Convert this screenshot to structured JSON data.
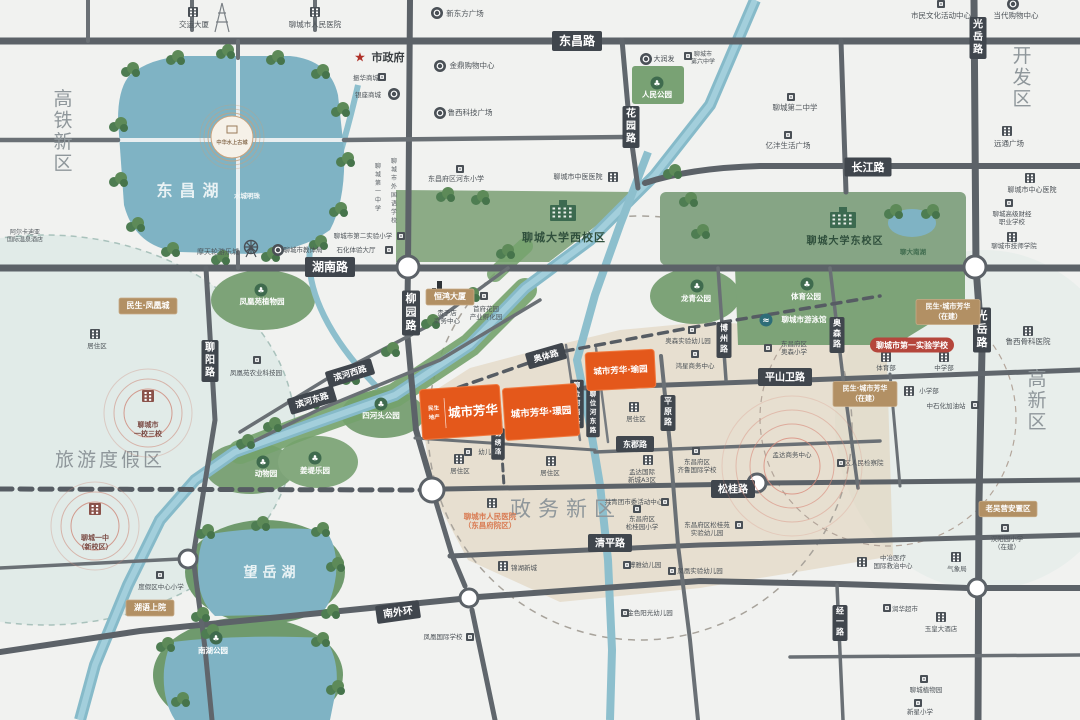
{
  "colors": {
    "project_orange": "#e4581b",
    "badge_gold": "#b29064",
    "road_badge": "#40464d",
    "badge_red": "#b5463c",
    "water": "#7fb3c4",
    "park_green": "#7da378",
    "region_gray": "#8f979b"
  },
  "map": {
    "regions": [
      {
        "text": "高铁新区",
        "x": 63,
        "y": 105,
        "v": 1,
        "fs": 19
      },
      {
        "text": "开发区",
        "x": 1022,
        "y": 62,
        "v": 1,
        "fs": 19
      },
      {
        "text": "高新区",
        "x": 1037,
        "y": 385,
        "v": 1,
        "fs": 19
      },
      {
        "text": "旅游度假区",
        "x": 110,
        "y": 466,
        "fs": 19,
        "ls": 3
      },
      {
        "text": "政务新区",
        "x": 566,
        "y": 516,
        "fs": 21,
        "ls": 7
      }
    ],
    "water_labels": [
      {
        "text": "东昌湖",
        "x": 191,
        "y": 196,
        "fs": 16,
        "ls": 7,
        "color": "#e9f2f4"
      },
      {
        "text": "望岳湖",
        "x": 272,
        "y": 577,
        "fs": 14,
        "ls": 5,
        "color": "#eaf3f5"
      },
      {
        "text": "水城明珠",
        "x": 247,
        "y": 198,
        "fs": 6.5,
        "color": "#f2f7f8"
      },
      {
        "text": "聊大南湖",
        "x": 913,
        "y": 254,
        "fs": 6.5,
        "color": "#3f6b4e"
      }
    ],
    "road_labels": [
      {
        "text": "东昌路",
        "x": 577,
        "y": 41,
        "fs": 12
      },
      {
        "text": "长江路",
        "x": 868,
        "y": 167,
        "fs": 11
      },
      {
        "text": "湖南路",
        "x": 330,
        "y": 267,
        "fs": 12
      },
      {
        "text": "柳园路",
        "x": 411,
        "y": 313,
        "v": 1,
        "fs": 11
      },
      {
        "text": "花园路",
        "x": 631,
        "y": 127,
        "v": 1,
        "fs": 10
      },
      {
        "text": "聊阳路",
        "x": 210,
        "y": 361,
        "v": 1,
        "fs": 10
      },
      {
        "text": "光岳路",
        "x": 978,
        "y": 38,
        "v": 1,
        "fs": 10
      },
      {
        "text": "光岳路",
        "x": 982,
        "y": 330,
        "v": 1,
        "fs": 11
      },
      {
        "text": "平原路",
        "x": 668,
        "y": 413,
        "v": 1,
        "fs": 8
      },
      {
        "text": "博州路",
        "x": 724,
        "y": 340,
        "v": 1,
        "fs": 8
      },
      {
        "text": "奥森路",
        "x": 837,
        "y": 335,
        "v": 1,
        "fs": 8
      },
      {
        "text": "经一路",
        "x": 840,
        "y": 623,
        "v": 1,
        "fs": 8
      },
      {
        "text": "平山卫路",
        "x": 785,
        "y": 377,
        "fs": 10
      },
      {
        "text": "东郡路",
        "x": 635,
        "y": 444,
        "fs": 8
      },
      {
        "text": "松桂路",
        "x": 733,
        "y": 489,
        "fs": 10
      },
      {
        "text": "清平路",
        "x": 610,
        "y": 543,
        "fs": 10
      },
      {
        "text": "南外环",
        "x": 398,
        "y": 612,
        "rot": -8,
        "fs": 10
      },
      {
        "text": "滨河西路",
        "x": 350,
        "y": 373,
        "rot": -17,
        "fs": 8.5
      },
      {
        "text": "滨河东路",
        "x": 312,
        "y": 400,
        "rot": -17,
        "fs": 8.5
      },
      {
        "text": "奥体路",
        "x": 546,
        "y": 356,
        "rot": -16,
        "fs": 8.5
      },
      {
        "text": "聊位河西路",
        "x": 577,
        "y": 404,
        "v": 1,
        "fs": 6.5
      },
      {
        "text": "聊位河东路",
        "x": 593,
        "y": 413,
        "v": 1,
        "fs": 6.5
      },
      {
        "text": "锦绣路",
        "x": 498,
        "y": 444,
        "v": 1,
        "fs": 6.5
      }
    ],
    "campuses": [
      {
        "lines": [
          "聊城大学西校区"
        ],
        "x": 564,
        "y": 241,
        "ix": 563,
        "iy": 213,
        "fs": 11
      },
      {
        "lines": [
          "聊城大学东校区"
        ],
        "x": 845,
        "y": 244,
        "ix": 843,
        "iy": 220,
        "fs": 10
      }
    ],
    "parks": [
      {
        "text": "人民公园",
        "x": 657,
        "y": 97,
        "ix": 657,
        "iy": 83
      },
      {
        "text": "凤凰苑植物园",
        "x": 262,
        "y": 304,
        "ix": 261,
        "iy": 290
      },
      {
        "text": "龙青公园",
        "x": 696,
        "y": 301,
        "ix": 697,
        "iy": 286
      },
      {
        "text": "体育公园",
        "x": 806,
        "y": 299,
        "ix": 807,
        "iy": 284
      },
      {
        "text": "聊城市游泳馆",
        "x": 804,
        "y": 322,
        "ix": 766,
        "iy": 320,
        "swim": 1
      },
      {
        "text": "四河头公园",
        "x": 381,
        "y": 418,
        "ix": 381,
        "iy": 404
      },
      {
        "text": "动物园",
        "x": 266,
        "y": 476,
        "ix": 263,
        "iy": 462
      },
      {
        "text": "姜堤乐园",
        "x": 315,
        "y": 473,
        "ix": 315,
        "iy": 458
      },
      {
        "text": "南湖公园",
        "x": 213,
        "y": 653,
        "ix": 216,
        "iy": 638
      }
    ],
    "pois": [
      {
        "lines": [
          "交运大厦"
        ],
        "x": 194,
        "y": 27,
        "ix": 193,
        "iy": 12,
        "icon": "b"
      },
      {
        "lines": [
          "聊城市人民医院"
        ],
        "x": 315,
        "y": 27,
        "ix": 315,
        "iy": 12,
        "icon": "b"
      },
      {
        "lines": [
          "新东方广场"
        ],
        "x": 465,
        "y": 16,
        "ix": 437,
        "iy": 13,
        "icon": "c"
      },
      {
        "lines": [
          "市民文化活动中心"
        ],
        "x": 941,
        "y": 18,
        "ix": 941,
        "iy": 4,
        "icon": "s"
      },
      {
        "lines": [
          "当代购物中心"
        ],
        "x": 1016,
        "y": 18,
        "ix": 1013,
        "iy": 4,
        "icon": "c"
      },
      {
        "lines": [
          "市政府"
        ],
        "x": 388,
        "y": 61,
        "ix": 360,
        "iy": 57,
        "icon": "star",
        "fs": 11,
        "color": "#3a3f42",
        "bold": 1
      },
      {
        "lines": [
          "金鼎购物中心"
        ],
        "x": 472,
        "y": 68,
        "ix": 440,
        "iy": 66,
        "icon": "c"
      },
      {
        "lines": [
          "振华商城"
        ],
        "x": 366,
        "y": 80,
        "ix": 382,
        "iy": 77,
        "icon": "s",
        "fs": 6.5
      },
      {
        "lines": [
          "银座商城"
        ],
        "x": 368,
        "y": 97,
        "ix": 394,
        "iy": 94,
        "icon": "c",
        "fs": 6.5
      },
      {
        "lines": [
          "鲁西科技广场"
        ],
        "x": 470,
        "y": 115,
        "ix": 440,
        "iy": 113,
        "icon": "c"
      },
      {
        "lines": [
          "大润发"
        ],
        "x": 664,
        "y": 61,
        "ix": 646,
        "iy": 59,
        "icon": "c",
        "fs": 7
      },
      {
        "lines": [
          "聊城市",
          "第六中学"
        ],
        "x": 703,
        "y": 56,
        "ix": 688,
        "iy": 56,
        "icon": "s",
        "fs": 6
      },
      {
        "lines": [
          "聊城第二中学"
        ],
        "x": 795,
        "y": 110,
        "ix": 791,
        "iy": 97,
        "icon": "s"
      },
      {
        "lines": [
          "亿沣生活广场"
        ],
        "x": 788,
        "y": 148,
        "ix": 788,
        "iy": 135,
        "icon": "s"
      },
      {
        "lines": [
          "远通广场"
        ],
        "x": 1009,
        "y": 146,
        "ix": 1007,
        "iy": 131,
        "icon": "b"
      },
      {
        "lines": [
          "聊城市中心医院"
        ],
        "x": 1032,
        "y": 192,
        "ix": 1030,
        "iy": 178,
        "icon": "b",
        "fs": 7
      },
      {
        "lines": [
          "聊城高级财经",
          "职业学校"
        ],
        "x": 1012,
        "y": 216,
        "ix": 1009,
        "iy": 203,
        "icon": "s",
        "fs": 6.5
      },
      {
        "lines": [
          "聊城市技师学院"
        ],
        "x": 1014,
        "y": 248,
        "ix": 1012,
        "iy": 237,
        "icon": "b",
        "fs": 6.5
      },
      {
        "lines": [
          "鲁西骨科医院"
        ],
        "x": 1028,
        "y": 344,
        "ix": 1028,
        "iy": 331,
        "icon": "b"
      },
      {
        "lines": [
          "东昌府区河东小学"
        ],
        "x": 456,
        "y": 181,
        "ix": 460,
        "iy": 169,
        "icon": "s",
        "fs": 7
      },
      {
        "lines": [
          "聊城市中医医院"
        ],
        "x": 578,
        "y": 179,
        "ix": 613,
        "iy": 177,
        "icon": "b",
        "fs": 7
      },
      {
        "text": "聊城市外国语学校",
        "x": 394,
        "y": 163,
        "v": 1,
        "fs": 6
      },
      {
        "text": "聊城第一中学",
        "x": 378,
        "y": 168,
        "v": 1,
        "fs": 6
      },
      {
        "lines": [
          "聊城市第二实验小学"
        ],
        "x": 363,
        "y": 238,
        "ix": 401,
        "iy": 236,
        "icon": "s",
        "fs": 6.5
      },
      {
        "lines": [
          "石化体验大厅"
        ],
        "x": 356,
        "y": 252,
        "ix": 389,
        "iy": 250,
        "icon": "s",
        "fs": 6.5
      },
      {
        "lines": [
          "聊城市教体局"
        ],
        "x": 303,
        "y": 252,
        "ix": 278,
        "iy": 250,
        "icon": "c",
        "fs": 6.5
      },
      {
        "lines": [
          "摩天轮游乐城"
        ],
        "x": 218,
        "y": 254,
        "ix": 251,
        "iy": 247,
        "icon": "f",
        "fs": 7
      },
      {
        "lines": [
          "阿尔卡迪亚",
          "国际温泉酒店"
        ],
        "x": 25,
        "y": 234,
        "fs": 6
      },
      {
        "lines": [
          "贵子店",
          "商务中心"
        ],
        "x": 447,
        "y": 315,
        "ix": 440,
        "iy": 292,
        "icon": "t",
        "fs": 6.5
      },
      {
        "lines": [
          "首府花园",
          "产业孵化园"
        ],
        "x": 486,
        "y": 311,
        "ix": 484,
        "iy": 296,
        "icon": "s",
        "fs": 6.5
      },
      {
        "lines": [
          "凤凰苑农业科技园"
        ],
        "x": 256,
        "y": 375,
        "ix": 257,
        "iy": 360,
        "icon": "s",
        "fs": 6.5
      },
      {
        "lines": [
          "居住区"
        ],
        "x": 97,
        "y": 348,
        "ix": 95,
        "iy": 334,
        "icon": "b",
        "fs": 6.5
      },
      {
        "lines": [
          "居住区"
        ],
        "x": 460,
        "y": 473,
        "ix": 459,
        "iy": 459,
        "icon": "b",
        "fs": 6.5
      },
      {
        "lines": [
          "居住区"
        ],
        "x": 550,
        "y": 475,
        "ix": 551,
        "iy": 461,
        "icon": "b",
        "fs": 6.5
      },
      {
        "lines": [
          "居住区"
        ],
        "x": 636,
        "y": 421,
        "ix": 634,
        "iy": 407,
        "icon": "b",
        "fs": 6.5
      },
      {
        "lines": [
          "幼儿园"
        ],
        "x": 488,
        "y": 454,
        "ix": 468,
        "iy": 452,
        "icon": "s",
        "fs": 6.5
      },
      {
        "lines": [
          "孟达国际",
          "新城A3区"
        ],
        "x": 642,
        "y": 474,
        "ix": 648,
        "iy": 460,
        "icon": "b",
        "fs": 6.5
      },
      {
        "lines": [
          "共青团市委活动中心"
        ],
        "x": 634,
        "y": 504,
        "ix": 665,
        "iy": 502,
        "icon": "s",
        "fs": 6.5
      },
      {
        "lines": [
          "东昌府区",
          "松桂园小学"
        ],
        "x": 642,
        "y": 521,
        "ix": 637,
        "iy": 509,
        "icon": "s",
        "fs": 6.5
      },
      {
        "lines": [
          "东昌府区",
          "齐鲁国际学校"
        ],
        "x": 697,
        "y": 464,
        "ix": 696,
        "iy": 451,
        "icon": "s",
        "fs": 6.5
      },
      {
        "lines": [
          "东昌府区松桂苑",
          "实验幼儿园"
        ],
        "x": 707,
        "y": 527,
        "ix": 739,
        "iy": 525,
        "icon": "s",
        "fs": 6.5
      },
      {
        "lines": [
          "聊城市人民医院",
          "（东昌府院区）"
        ],
        "x": 490,
        "y": 519,
        "ix": 492,
        "iy": 503,
        "icon": "b",
        "fs": 7.5,
        "color": "#d97b52",
        "bold": 1
      },
      {
        "lines": [
          "锦湖新城"
        ],
        "x": 524,
        "y": 570,
        "ix": 503,
        "iy": 566,
        "icon": "b",
        "fs": 6.5
      },
      {
        "lines": [
          "凤凰国际学校"
        ],
        "x": 443,
        "y": 639,
        "ix": 470,
        "iy": 637,
        "icon": "s",
        "fs": 6.5
      },
      {
        "lines": [
          "博雅幼儿园"
        ],
        "x": 645,
        "y": 567,
        "ix": 627,
        "iy": 565,
        "icon": "s",
        "fs": 6.5
      },
      {
        "lines": [
          "凤凰实验幼儿园"
        ],
        "x": 700,
        "y": 573,
        "ix": 672,
        "iy": 571,
        "icon": "s",
        "fs": 6.5
      },
      {
        "lines": [
          "金色阳光幼儿园"
        ],
        "x": 650,
        "y": 615,
        "ix": 625,
        "iy": 613,
        "icon": "s",
        "fs": 6.5
      },
      {
        "lines": [
          "度假区中心小学"
        ],
        "x": 161,
        "y": 589,
        "ix": 160,
        "iy": 575,
        "icon": "s",
        "fs": 6.5
      },
      {
        "lines": [
          "润华超市"
        ],
        "x": 905,
        "y": 611,
        "ix": 887,
        "iy": 608,
        "icon": "s",
        "fs": 6.5
      },
      {
        "lines": [
          "玉皇大酒店"
        ],
        "x": 941,
        "y": 631,
        "ix": 941,
        "iy": 617,
        "icon": "b",
        "fs": 6.5
      },
      {
        "lines": [
          "中冶医疗",
          "国际救治中心"
        ],
        "x": 893,
        "y": 560,
        "ix": 862,
        "iy": 562,
        "icon": "b",
        "fs": 6.5
      },
      {
        "lines": [
          "气象局"
        ],
        "x": 957,
        "y": 571,
        "ix": 956,
        "iy": 557,
        "icon": "b",
        "fs": 6.5
      },
      {
        "lines": [
          "汉阳园小学",
          "（在建）"
        ],
        "x": 1007,
        "y": 541,
        "ix": 1005,
        "iy": 528,
        "icon": "s",
        "fs": 6.5
      },
      {
        "lines": [
          "聊城植物园"
        ],
        "x": 926,
        "y": 692,
        "ix": 924,
        "iy": 679,
        "icon": "s",
        "fs": 6.5
      },
      {
        "lines": [
          "新星小学"
        ],
        "x": 920,
        "y": 714,
        "ix": 918,
        "iy": 703,
        "icon": "s",
        "fs": 6.5
      },
      {
        "lines": [
          "孟达商务中心"
        ],
        "x": 792,
        "y": 457,
        "fs": 6.5
      },
      {
        "lines": [
          "区人民检察院"
        ],
        "x": 864,
        "y": 465,
        "ix": 841,
        "iy": 463,
        "icon": "s",
        "fs": 6.5
      },
      {
        "lines": [
          "体育部"
        ],
        "x": 886,
        "y": 370,
        "ix": 886,
        "iy": 357,
        "icon": "b",
        "fs": 6.5
      },
      {
        "lines": [
          "中学部"
        ],
        "x": 944,
        "y": 370,
        "ix": 944,
        "iy": 357,
        "icon": "b",
        "fs": 6.5
      },
      {
        "lines": [
          "小学部"
        ],
        "x": 929,
        "y": 393,
        "ix": 909,
        "iy": 391,
        "icon": "b",
        "fs": 6.5
      },
      {
        "lines": [
          "中石化加油站"
        ],
        "x": 946,
        "y": 408,
        "ix": 975,
        "iy": 405,
        "icon": "s",
        "fs": 6.5
      },
      {
        "lines": [
          "鸿星商务中心"
        ],
        "x": 695,
        "y": 368,
        "ix": 695,
        "iy": 354,
        "icon": "s",
        "fs": 6.5
      },
      {
        "lines": [
          "奥森实验幼儿园"
        ],
        "x": 688,
        "y": 343,
        "ix": 692,
        "iy": 330,
        "icon": "s",
        "fs": 6.5
      },
      {
        "lines": [
          "东昌府区",
          "奥森小学"
        ],
        "x": 794,
        "y": 346,
        "ix": 768,
        "iy": 348,
        "icon": "s",
        "fs": 6.5
      }
    ],
    "gold_badges": [
      {
        "lines": [
          "民生·凤凰城"
        ],
        "x": 148,
        "y": 306,
        "w": 58,
        "fs": 8
      },
      {
        "lines": [
          "恒鸿大厦"
        ],
        "x": 450,
        "y": 297,
        "w": 48,
        "fs": 8
      },
      {
        "lines": [
          "民生·城市芳华",
          "（在建）"
        ],
        "x": 948,
        "y": 312,
        "w": 64,
        "fs": 7
      },
      {
        "lines": [
          "民生·城市芳华",
          "（在建）"
        ],
        "x": 865,
        "y": 394,
        "w": 64,
        "fs": 7
      },
      {
        "lines": [
          "湖语上院"
        ],
        "x": 150,
        "y": 608,
        "w": 48,
        "fs": 8
      },
      {
        "lines": [
          "老吴营安置区"
        ],
        "x": 1008,
        "y": 509,
        "w": 58,
        "fs": 7.5
      }
    ],
    "red_badges": [
      {
        "lines": [
          "聊城市第一实验学校"
        ],
        "x": 912,
        "y": 345,
        "w": 84,
        "fs": 8
      }
    ],
    "circle_pois": [
      {
        "lines": [
          "聊城市",
          "一校三校"
        ],
        "x": 148,
        "y": 413,
        "iy": 396
      },
      {
        "lines": [
          "聊城一中",
          "（新校区）"
        ],
        "x": 95,
        "y": 526,
        "iy": 509
      }
    ],
    "ring_highlights": [
      {
        "x": 792,
        "y": 466,
        "radii": [
          28,
          42,
          56,
          70
        ]
      }
    ],
    "project_blocks": [
      {
        "prefix": [
          "民生",
          "地产"
        ],
        "name": "城市芳华",
        "x": 421,
        "y": 387,
        "w": 80,
        "h": 50,
        "rot": -4,
        "fs": 12.5
      },
      {
        "name": "城市芳华·璟园",
        "x": 504,
        "y": 386,
        "w": 74,
        "h": 52,
        "rot": -4,
        "fs": 9.5
      },
      {
        "name": "城市芳华·瑜园",
        "x": 586,
        "y": 351,
        "w": 69,
        "h": 38,
        "rot": -3,
        "fs": 8.5
      }
    ],
    "landmark": {
      "text": "中华水上古城",
      "x": 232,
      "y": 144
    }
  }
}
